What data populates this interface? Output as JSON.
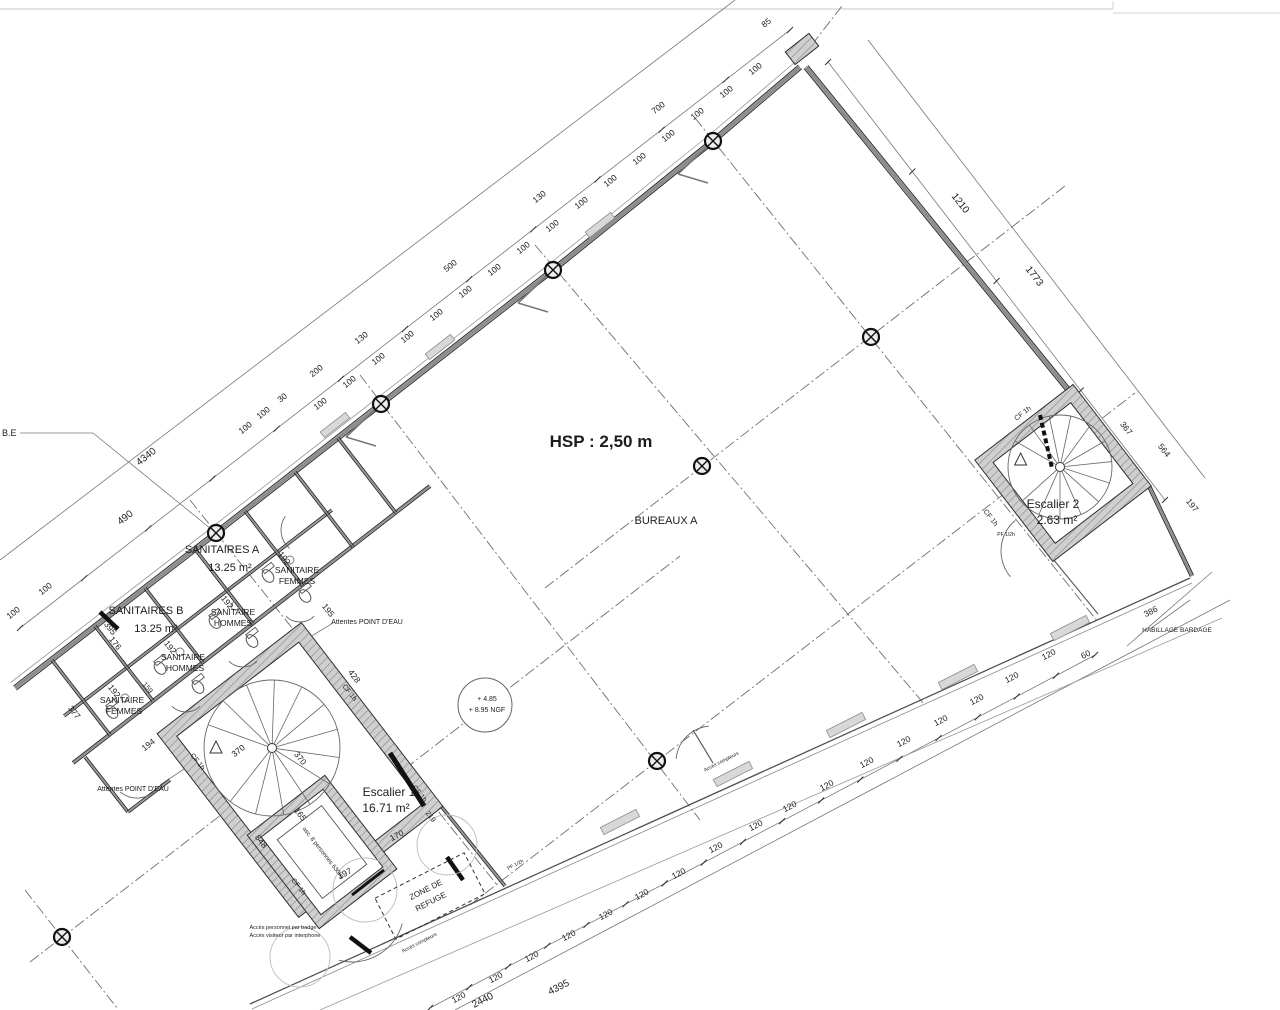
{
  "colors": {
    "ink": "#1c1c1c",
    "line": "#4a4a4a",
    "wall_core": "#8d8d8d",
    "wall_edge": "#2e2e2e",
    "wall_fill": "#cfcfcf",
    "hatch": "#8f8f8f",
    "dash": "#6f6f6f",
    "dim": "#2f2f2f",
    "light": "#e3e3e3",
    "thin": "#777777",
    "bg": "#ffffff"
  },
  "plan": {
    "labels": [
      {
        "i": "fragment-ble",
        "t": "B.E",
        "x": 2,
        "y": 436,
        "s": 9,
        "a": "start"
      },
      {
        "i": "hsp-height-label",
        "t": "HSP : 2,50 m",
        "x": 601,
        "y": 447,
        "s": 17,
        "w": "bold"
      },
      {
        "i": "room-bureaux-a",
        "t": "BUREAUX A",
        "x": 666,
        "y": 524,
        "s": 11
      },
      {
        "i": "room-sanitaires-a",
        "t": "SANITAIRES A",
        "x": 222,
        "y": 553,
        "s": 11
      },
      {
        "i": "room-sanitaires-a-area",
        "t": "13.25 m²",
        "x": 230,
        "y": 571,
        "s": 11
      },
      {
        "i": "room-sanitaire-femmes-a1",
        "t": "SANITAIRE",
        "x": 297,
        "y": 573,
        "s": 8.5
      },
      {
        "i": "room-sanitaire-femmes-a2",
        "t": "FEMMES",
        "x": 297,
        "y": 584,
        "s": 8.5
      },
      {
        "i": "room-sanitaires-b",
        "t": "SANITAIRES B",
        "x": 146,
        "y": 614,
        "s": 11
      },
      {
        "i": "room-sanitaires-b-area",
        "t": "13.25 m²",
        "x": 156,
        "y": 632,
        "s": 11
      },
      {
        "i": "room-sanitaire-hommes-a1",
        "t": "SANITAIRE",
        "x": 233,
        "y": 615,
        "s": 8.5
      },
      {
        "i": "room-sanitaire-hommes-a2",
        "t": "HOMMES",
        "x": 233,
        "y": 626,
        "s": 8.5
      },
      {
        "i": "room-sanitaire-hommes-b1",
        "t": "SANITAIRE",
        "x": 183,
        "y": 660,
        "s": 8.5
      },
      {
        "i": "room-sanitaire-hommes-b2",
        "t": "HOMMES",
        "x": 185,
        "y": 671,
        "s": 8.5
      },
      {
        "i": "room-sanitaire-femmes-b1",
        "t": "SANITAIRE",
        "x": 122,
        "y": 703,
        "s": 8.5
      },
      {
        "i": "room-sanitaire-femmes-b2",
        "t": "FEMMES",
        "x": 124,
        "y": 714,
        "s": 8.5
      },
      {
        "i": "room-escalier-1",
        "t": "Escalier 1",
        "x": 389,
        "y": 796,
        "s": 12
      },
      {
        "i": "room-escalier-1-area",
        "t": "16.71 m²",
        "x": 386,
        "y": 812,
        "s": 12
      },
      {
        "i": "room-escalier-2",
        "t": "Escalier 2",
        "x": 1053,
        "y": 508,
        "s": 12
      },
      {
        "i": "room-escalier-2-area",
        "t": "2.63 m²",
        "x": 1057,
        "y": 524,
        "s": 12
      },
      {
        "i": "zone-refuge-1",
        "t": "ZONE DE",
        "x": 427,
        "y": 892,
        "s": 8,
        "r": -27
      },
      {
        "i": "zone-refuge-2",
        "t": "REFUGE",
        "x": 432,
        "y": 904,
        "s": 8,
        "r": -27
      },
      {
        "i": "attentes-point-eau-1",
        "t": "Attentes POINT D'EAU",
        "x": 367,
        "y": 624,
        "s": 7
      },
      {
        "i": "attentes-point-eau-2",
        "t": "Attentes POINT D'EAU",
        "x": 133,
        "y": 791,
        "s": 7
      },
      {
        "i": "habillage-bardage",
        "t": "HABILLAGE BARDAGE",
        "x": 1177,
        "y": 632,
        "s": 6.5
      },
      {
        "i": "acces-badge-1",
        "t": "Accès personnel par badge",
        "x": 283,
        "y": 929,
        "s": 5.5
      },
      {
        "i": "acces-badge-2",
        "t": "Accès visiteur par interphone",
        "x": 285,
        "y": 937,
        "s": 5.5
      },
      {
        "i": "acces-compteurs-1",
        "t": "Accès compteurs",
        "x": 722,
        "y": 763,
        "s": 5,
        "r": -27
      },
      {
        "i": "acces-compteurs-2",
        "t": "Accès compteurs",
        "x": 420,
        "y": 944,
        "s": 5,
        "r": -27
      },
      {
        "i": "ngf-level-1",
        "t": "+ 4.85",
        "x": 487,
        "y": 701,
        "s": 7
      },
      {
        "i": "ngf-level-2",
        "t": "+ 8.95 NGF",
        "x": 487,
        "y": 712,
        "s": 7
      },
      {
        "i": "ascenseur-label",
        "t": "asc. 8 personnes 630kg",
        "x": 322,
        "y": 854,
        "s": 6,
        "r": 52
      },
      {
        "i": "fire-door-1",
        "t": "PF 1/2h",
        "x": 516,
        "y": 866,
        "s": 5,
        "r": -27
      },
      {
        "i": "fire-door-2",
        "t": "PF 1/2h",
        "x": 1006,
        "y": 536,
        "s": 5
      },
      {
        "i": "fire-wall-1",
        "t": "CF 1h",
        "x": 348,
        "y": 694,
        "s": 7,
        "r": 52
      },
      {
        "i": "fire-wall-2",
        "t": "CF 1h",
        "x": 196,
        "y": 763,
        "s": 7,
        "r": 52
      },
      {
        "i": "fire-wall-3",
        "t": "CF 1h",
        "x": 297,
        "y": 888,
        "s": 7,
        "r": 52
      },
      {
        "i": "fire-wall-4",
        "t": "CF 1h",
        "x": 1024,
        "y": 415,
        "s": 7,
        "r": -38
      },
      {
        "i": "fire-wall-5",
        "t": "CF 1h",
        "x": 989,
        "y": 519,
        "s": 7,
        "r": 52
      },
      {
        "i": "fire-wall-6",
        "t": "CF 1h",
        "x": 418,
        "y": 795,
        "s": 7,
        "r": 52
      }
    ],
    "dimensions": [
      {
        "t": "4340",
        "x": 148,
        "y": 459,
        "r": -38,
        "s": 10
      },
      {
        "t": "490",
        "x": 127,
        "y": 520,
        "r": -38,
        "s": 10
      },
      {
        "t": "100",
        "x": 15,
        "y": 615,
        "r": -38
      },
      {
        "t": "100",
        "x": 47,
        "y": 591,
        "r": -38
      },
      {
        "t": "100",
        "x": 247,
        "y": 430,
        "r": -38
      },
      {
        "t": "100",
        "x": 265,
        "y": 415,
        "r": -38
      },
      {
        "t": "30",
        "x": 284,
        "y": 400,
        "r": -38
      },
      {
        "t": "200",
        "x": 318,
        "y": 373,
        "r": -38
      },
      {
        "t": "130",
        "x": 363,
        "y": 340,
        "r": -38
      },
      {
        "t": "500",
        "x": 452,
        "y": 268,
        "r": -38
      },
      {
        "t": "130",
        "x": 541,
        "y": 199,
        "r": -38
      },
      {
        "t": "700",
        "x": 660,
        "y": 110,
        "r": -38
      },
      {
        "t": "85",
        "x": 768,
        "y": 25,
        "r": -38
      },
      {
        "t": "100",
        "x": 322,
        "y": 406,
        "r": -38
      },
      {
        "t": "100",
        "x": 351,
        "y": 384,
        "r": -38
      },
      {
        "t": "100",
        "x": 380,
        "y": 361,
        "r": -38
      },
      {
        "t": "100",
        "x": 409,
        "y": 339,
        "r": -38
      },
      {
        "t": "100",
        "x": 438,
        "y": 317,
        "r": -38
      },
      {
        "t": "100",
        "x": 467,
        "y": 294,
        "r": -38
      },
      {
        "t": "100",
        "x": 496,
        "y": 272,
        "r": -38
      },
      {
        "t": "100",
        "x": 525,
        "y": 250,
        "r": -38
      },
      {
        "t": "100",
        "x": 554,
        "y": 228,
        "r": -38
      },
      {
        "t": "100",
        "x": 583,
        "y": 205,
        "r": -38
      },
      {
        "t": "100",
        "x": 612,
        "y": 183,
        "r": -38
      },
      {
        "t": "100",
        "x": 641,
        "y": 161,
        "r": -38
      },
      {
        "t": "100",
        "x": 670,
        "y": 138,
        "r": -38
      },
      {
        "t": "100",
        "x": 699,
        "y": 116,
        "r": -38
      },
      {
        "t": "100",
        "x": 728,
        "y": 94,
        "r": -38
      },
      {
        "t": "100",
        "x": 757,
        "y": 71,
        "r": -38
      },
      {
        "t": "1210",
        "x": 958,
        "y": 205,
        "r": 52,
        "s": 10
      },
      {
        "t": "1773",
        "x": 1032,
        "y": 278,
        "r": 52,
        "s": 10
      },
      {
        "t": "367",
        "x": 1124,
        "y": 430,
        "r": 52
      },
      {
        "t": "564",
        "x": 1162,
        "y": 452,
        "r": 52
      },
      {
        "t": "197",
        "x": 1190,
        "y": 507,
        "r": 52
      },
      {
        "t": "386",
        "x": 1152,
        "y": 614,
        "r": -27
      },
      {
        "t": "60",
        "x": 1087,
        "y": 657,
        "r": -27
      },
      {
        "t": "120",
        "x": 460,
        "y": 1000,
        "r": -27
      },
      {
        "t": "120",
        "x": 497,
        "y": 980,
        "r": -27
      },
      {
        "t": "120",
        "x": 533,
        "y": 959,
        "r": -27
      },
      {
        "t": "120",
        "x": 570,
        "y": 938,
        "r": -27
      },
      {
        "t": "120",
        "x": 607,
        "y": 917,
        "r": -27
      },
      {
        "t": "120",
        "x": 643,
        "y": 897,
        "r": -27
      },
      {
        "t": "120",
        "x": 680,
        "y": 876,
        "r": -27
      },
      {
        "t": "120",
        "x": 717,
        "y": 850,
        "r": -27
      },
      {
        "t": "120",
        "x": 757,
        "y": 828,
        "r": -27
      },
      {
        "t": "120",
        "x": 791,
        "y": 809,
        "r": -27
      },
      {
        "t": "120",
        "x": 828,
        "y": 788,
        "r": -27
      },
      {
        "t": "120",
        "x": 868,
        "y": 765,
        "r": -27
      },
      {
        "t": "120",
        "x": 905,
        "y": 744,
        "r": -27
      },
      {
        "t": "120",
        "x": 942,
        "y": 723,
        "r": -27
      },
      {
        "t": "120",
        "x": 978,
        "y": 702,
        "r": -27
      },
      {
        "t": "120",
        "x": 1013,
        "y": 680,
        "r": -27
      },
      {
        "t": "120",
        "x": 1050,
        "y": 657,
        "r": -27
      },
      {
        "t": "2440",
        "x": 484,
        "y": 1003,
        "r": -27,
        "s": 10
      },
      {
        "t": "4395",
        "x": 560,
        "y": 990,
        "r": -27,
        "s": 10
      },
      {
        "t": "428",
        "x": 352,
        "y": 678,
        "r": 52
      },
      {
        "t": "370",
        "x": 298,
        "y": 760,
        "r": 52
      },
      {
        "t": "370",
        "x": 240,
        "y": 753,
        "r": -38
      },
      {
        "t": "165",
        "x": 298,
        "y": 816,
        "r": 52
      },
      {
        "t": "170",
        "x": 398,
        "y": 838,
        "r": -27
      },
      {
        "t": "848",
        "x": 259,
        "y": 843,
        "r": 52
      },
      {
        "t": "219",
        "x": 429,
        "y": 818,
        "r": 52,
        "s": 7
      },
      {
        "t": "197",
        "x": 346,
        "y": 876,
        "r": -27
      },
      {
        "t": "192",
        "x": 282,
        "y": 560,
        "r": 52
      },
      {
        "t": "192",
        "x": 225,
        "y": 604,
        "r": 52
      },
      {
        "t": "192",
        "x": 168,
        "y": 649,
        "r": 52
      },
      {
        "t": "192",
        "x": 112,
        "y": 693,
        "r": 52
      },
      {
        "t": "195",
        "x": 326,
        "y": 612,
        "r": 52
      },
      {
        "t": "176",
        "x": 113,
        "y": 645,
        "r": 52
      },
      {
        "t": "377",
        "x": 72,
        "y": 714,
        "r": 52
      },
      {
        "t": "194",
        "x": 150,
        "y": 747,
        "r": -38
      },
      {
        "t": "395",
        "x": 108,
        "y": 630,
        "r": 52
      },
      {
        "t": "159",
        "x": 146,
        "y": 689,
        "r": 52,
        "s": 7
      }
    ]
  }
}
